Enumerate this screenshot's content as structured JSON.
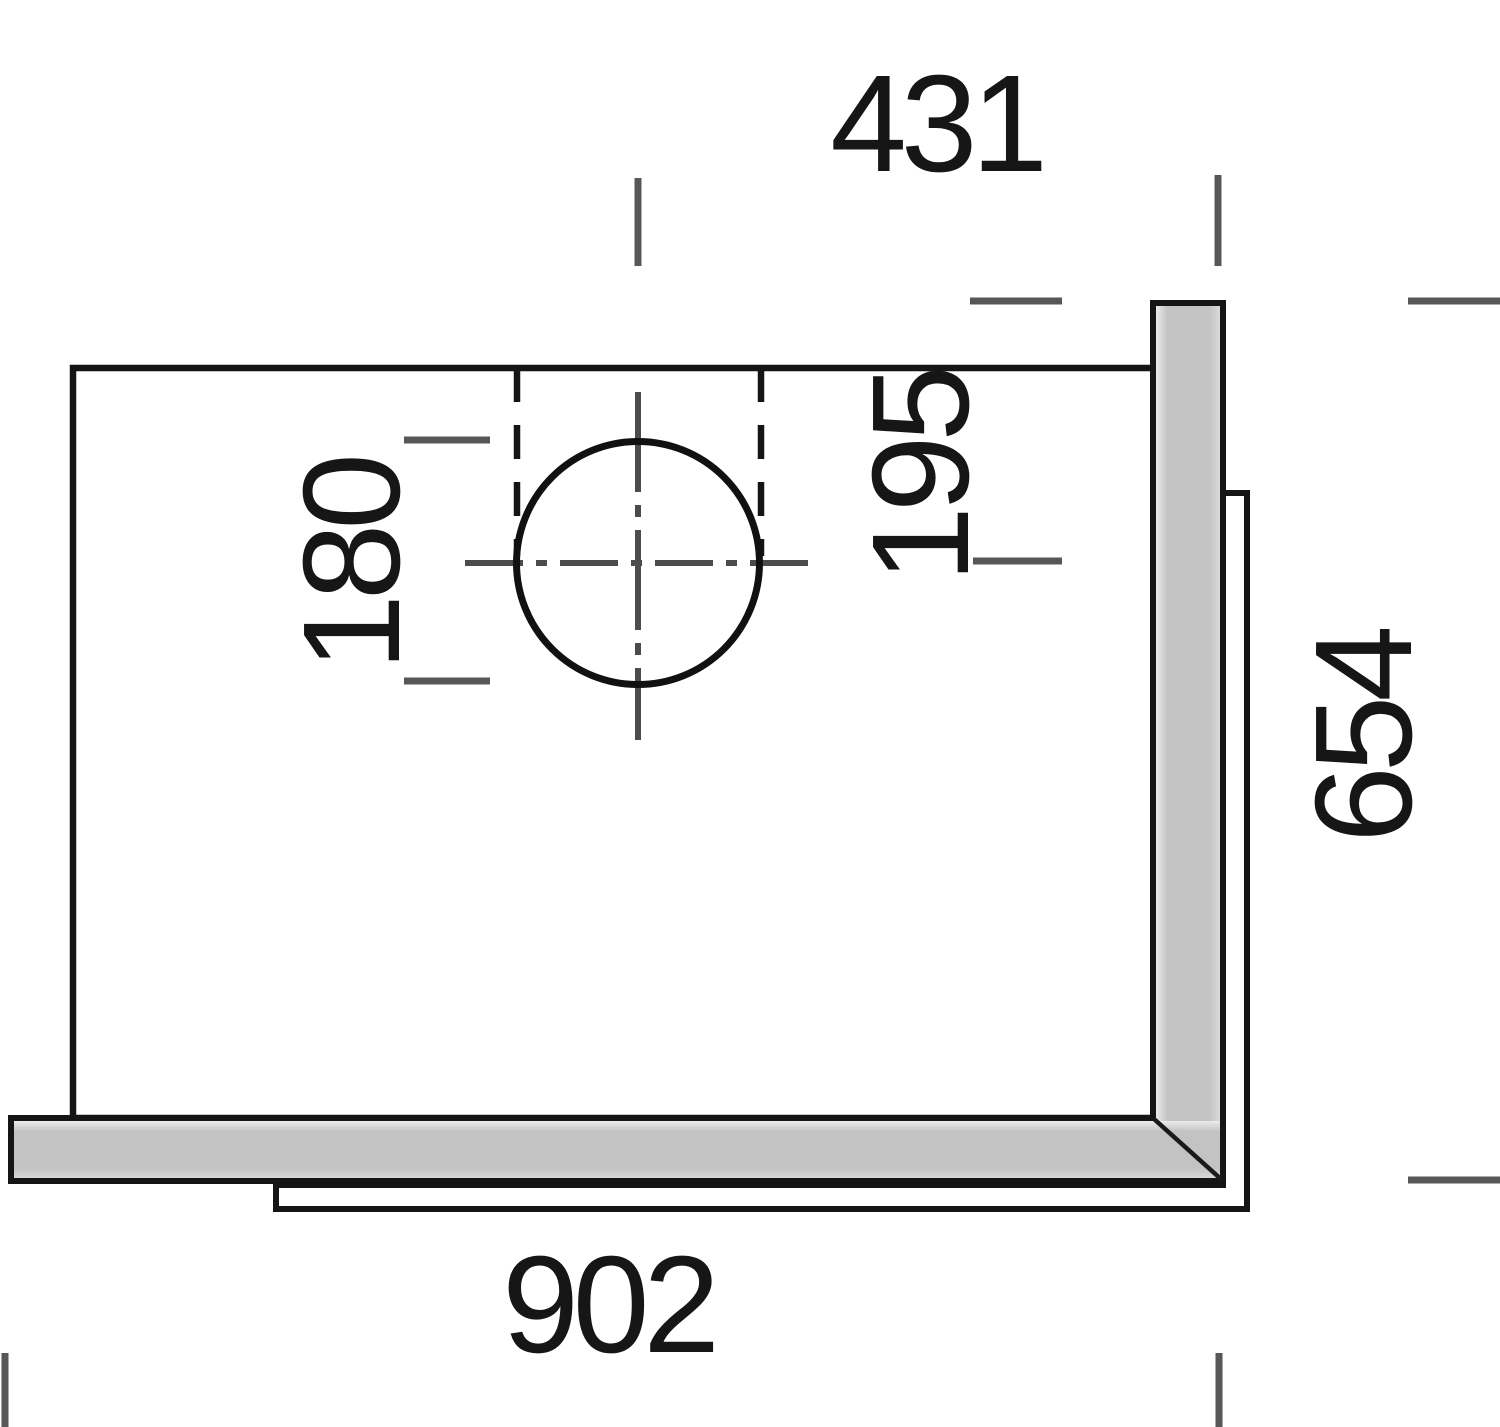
{
  "drawing": {
    "labels": {
      "d431": "431",
      "d195": "195",
      "d180": "180",
      "d654": "654",
      "d902": "902"
    },
    "colors": {
      "line": "#151515",
      "tick": "#575757",
      "centerline": "#4c4c4c",
      "edge_fill": "#c3c3c3",
      "edge_highlight": "#ececec",
      "background": "#ffffff"
    }
  }
}
